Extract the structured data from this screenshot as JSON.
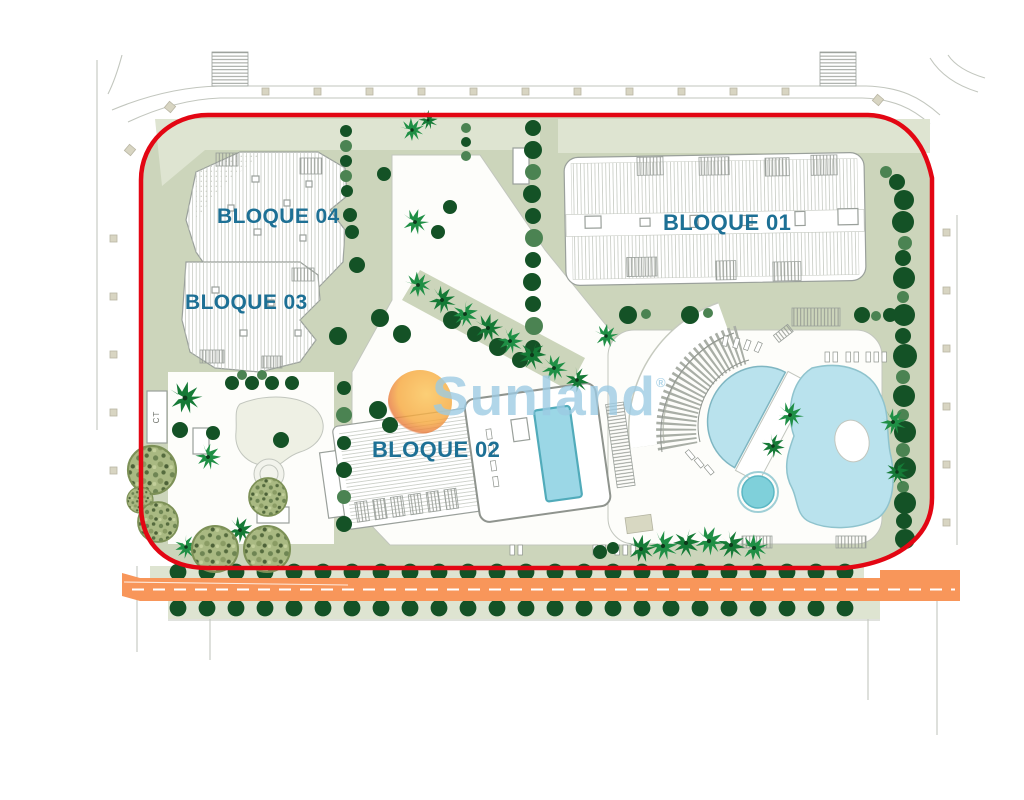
{
  "plan": {
    "blocks": [
      {
        "id": "bloque01",
        "label": "BLOQUE 01"
      },
      {
        "id": "bloque02",
        "label": "BLOQUE 02"
      },
      {
        "id": "bloque03",
        "label": "BLOQUE 03"
      },
      {
        "id": "bloque04",
        "label": "BLOQUE 04"
      }
    ],
    "utility_label": "CT"
  },
  "watermark": {
    "brand": "Sunland",
    "registered_mark": "®"
  },
  "colors": {
    "boundary_red": "#e30613",
    "site_green": "#ccd5bb",
    "light_green": "#dee4d1",
    "tree_dark": "#145226",
    "tree_mid": "#4b8352",
    "palm_green": "#1f8f45",
    "pool_blue": "#b9e2ed",
    "pool_lap": "#9bd7e6",
    "pool_teal": "#7fd0da",
    "road_orange": "#f8965a",
    "label_blue": "#1d7095",
    "watermark_blue": "#9ccbe3",
    "sun_orange": "#f6a73b"
  }
}
